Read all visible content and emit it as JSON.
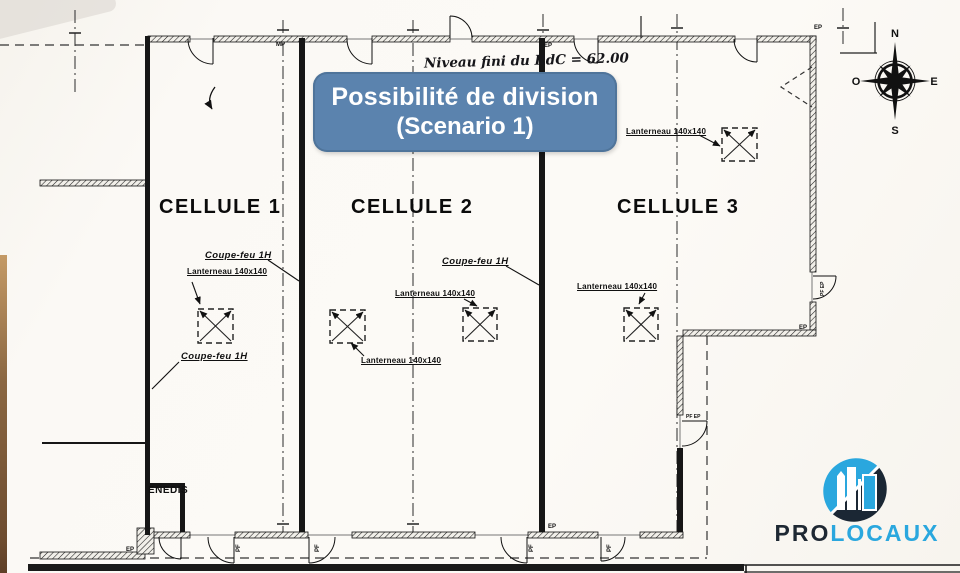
{
  "banner": {
    "line1": "Possibilité de division",
    "line2": "(Scenario 1)"
  },
  "plan": {
    "handwritten_note": "Niveau fini du RdC = 62.00",
    "cells": [
      "CELLULE 1",
      "CELLULE 2",
      "CELLULE 3"
    ],
    "fire_rating_label": "Coupe-feu 1H",
    "skylight_label": "Lanterneau 140x140",
    "utility_room_label": "ENEDIS",
    "tags": {
      "mp": "MP",
      "ep": "EP",
      "pf": "PF",
      "pf_ep": "PF EP"
    }
  },
  "compass": {
    "north": "N",
    "east": "E",
    "south": "S",
    "west": "O"
  },
  "logo": {
    "pro": "PRO",
    "locaux": "LOCAUX"
  },
  "colors": {
    "banner_bg": "#5b83ae",
    "logo_blue": "#2aa7de",
    "logo_dark": "#1e2833",
    "ink": "#111111",
    "paper": "#faf8f4"
  }
}
